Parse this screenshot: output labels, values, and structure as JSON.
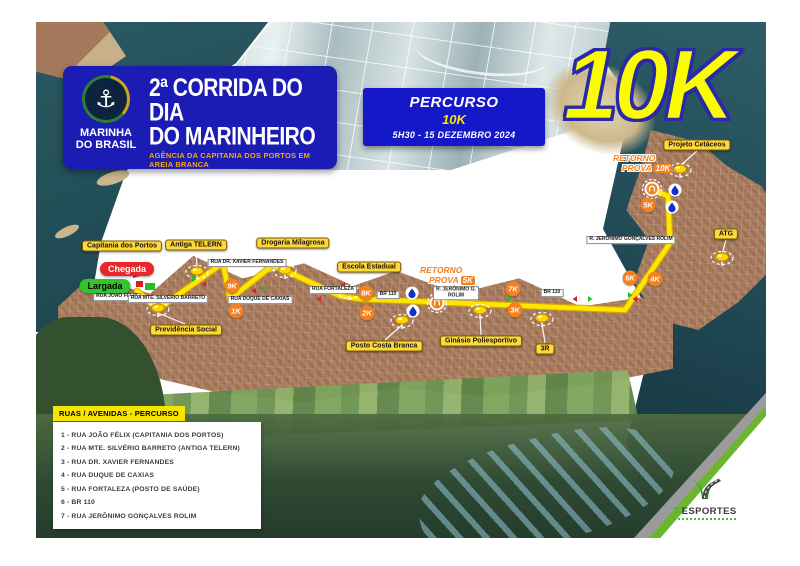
{
  "header": {
    "organization": {
      "line1": "MARINHA",
      "line2": "DO BRASIL"
    },
    "title_line1": "2ª CORRIDA DO DIA",
    "title_line2": "DO MARINHEIRO",
    "subtitle": "AGÊNCIA DA CAPITANIA DOS PORTOS EM AREIA BRANCA"
  },
  "icons": {
    "anchor": "⚓"
  },
  "race_info": {
    "label": "PERCURSO",
    "distance": "10K",
    "schedule": "5H30 - 15 DEZEMBRO 2024"
  },
  "distance_overlay": "10K",
  "map": {
    "start_label": "Largada",
    "finish_label": "Chegada",
    "pins": [
      {
        "label": "Capitania dos Portos"
      },
      {
        "label": "Antiga TELERN"
      },
      {
        "label": "Drogaria Milagrosa"
      },
      {
        "label": "Escola Estadual"
      },
      {
        "label": "Posto Costa Branca"
      },
      {
        "label": "Ginásio Poliesportivo"
      },
      {
        "label": "3R"
      },
      {
        "label": "Previdência Social"
      },
      {
        "label": "Projeto Cetáceos"
      },
      {
        "label": "ATG"
      }
    ],
    "km_markers": [
      "9K",
      "1K",
      "8K",
      "2K",
      "7K",
      "3K",
      "6K",
      "4K",
      "5K"
    ],
    "turnaround_5k": {
      "line1": "RETORNO",
      "line2": "PROVA",
      "badge": "5K"
    },
    "turnaround_10k": {
      "line1": "RETORNO",
      "line2": "PROVA",
      "badge": "10K"
    },
    "street_signs": [
      "RUA JOÃO FÉLIX",
      "RUA MTE. SILVÉRIO BARRETO",
      "RUA DR. XAVIER FERNANDES",
      "RUA DUQUE DE CAXIAS",
      "RUA FORTALEZA",
      "BR 110",
      "R. JERÔNIMO G. ROLIM",
      "BR 110",
      "R. JERÔNIMO GONÇALVES ROLIM"
    ]
  },
  "legend": {
    "title": "RUAS / AVENIDAS - PERCURSO",
    "streets": [
      "1 - RUA JOÃO FÉLIX (CAPITANIA DOS PORTOS)",
      "2 - RUA MTE. SILVÉRIO BARRETO (ANTIGA TELERN)",
      "3 - RUA DR. XAVIER FERNANDES",
      "4 - RUA DUQUE DE CAXIAS",
      "5 - RUA FORTALEZA (POSTO DE SAÚDE)",
      "6 - BR 110",
      "7 - RUA JERÔNIMO GONÇALVES ROLIM"
    ]
  },
  "branding": {
    "name_prefix": "T.",
    "name": "ESPORTES"
  },
  "colors": {
    "header_blue": "#1b1cb4",
    "label_yellow": "#ffd83c",
    "route_yellow": "#ffe600",
    "km_orange": "#f48120",
    "start_green": "#35c42d",
    "finish_red": "#e8262d",
    "overlay_yellow": "#fcfc00"
  }
}
